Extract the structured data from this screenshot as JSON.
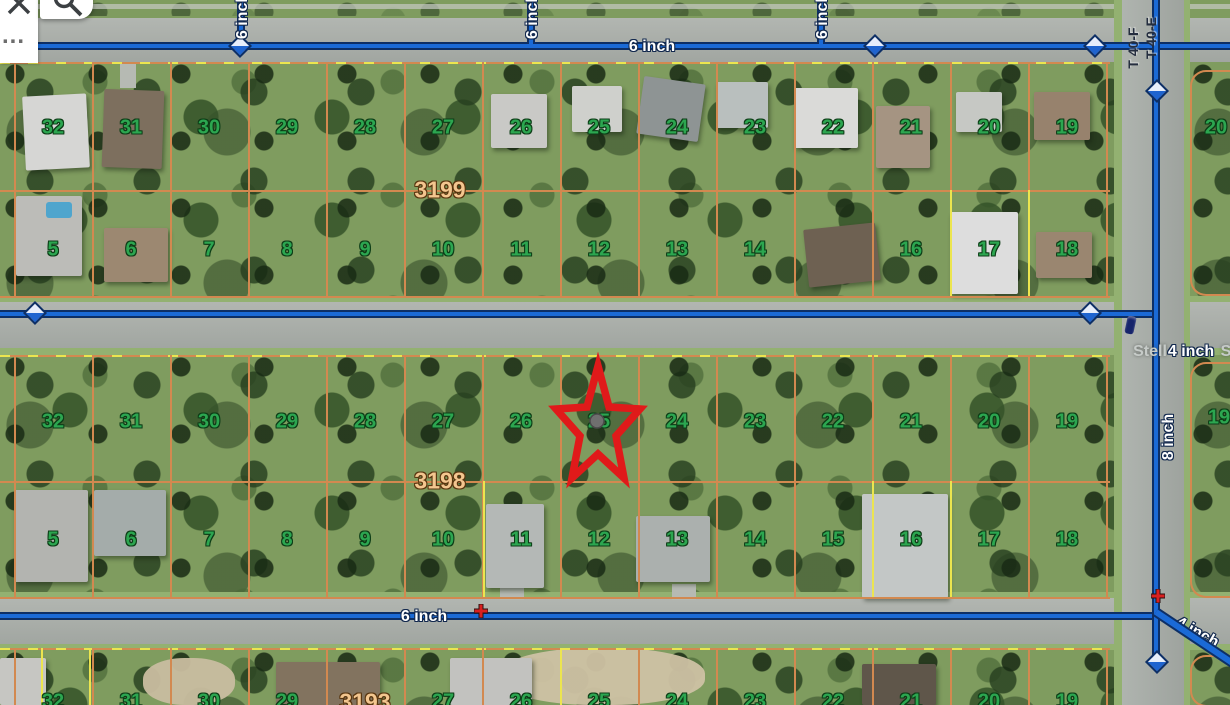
{
  "ui": {
    "ellipsis": "..."
  },
  "pipes": {
    "top": "6 inch",
    "bottom": "6 inch",
    "stubs": [
      "6 inch",
      "6 inch",
      "6 inch"
    ],
    "vertical": "8 inch",
    "middle_branch": "4 inch",
    "corner_branch": "4 inch"
  },
  "plat_labels": [
    "T 40-F",
    "T 40-E"
  ],
  "street": {
    "left": "Stell",
    "right": "S"
  },
  "blocks": {
    "b3199": {
      "label": "3199",
      "north": [
        "32",
        "31",
        "30",
        "29",
        "28",
        "27",
        "26",
        "25",
        "24",
        "23",
        "22",
        "21",
        "20",
        "19"
      ],
      "south": [
        "5",
        "6",
        "7",
        "8",
        "9",
        "10",
        "11",
        "12",
        "13",
        "14",
        null,
        "16",
        "17",
        "18"
      ]
    },
    "b3198": {
      "label": "3198",
      "north": [
        "32",
        "31",
        "30",
        "29",
        "28",
        "27",
        "26",
        "25",
        "24",
        "23",
        "22",
        "21",
        "20",
        "19"
      ],
      "south": [
        "5",
        "6",
        "7",
        "8",
        "9",
        "10",
        "11",
        "12",
        "13",
        "14",
        "15",
        "16",
        "17",
        "18"
      ]
    },
    "bottom_row": [
      "32",
      "31",
      "30",
      "29",
      "3193",
      "27",
      "26",
      "25",
      "24",
      "23",
      "22",
      "21",
      "20",
      "19"
    ],
    "east": [
      "20",
      "19"
    ]
  },
  "marker": {
    "starred_lot": "25"
  },
  "colors": {
    "pipe_blue": "#1b6ad6",
    "parcel_orange": "#d28950",
    "parcel_yellow": "#ece54f",
    "lot_green": "#2ca650",
    "block_tan": "#f3c68f",
    "star_red": "#e01a1a"
  }
}
